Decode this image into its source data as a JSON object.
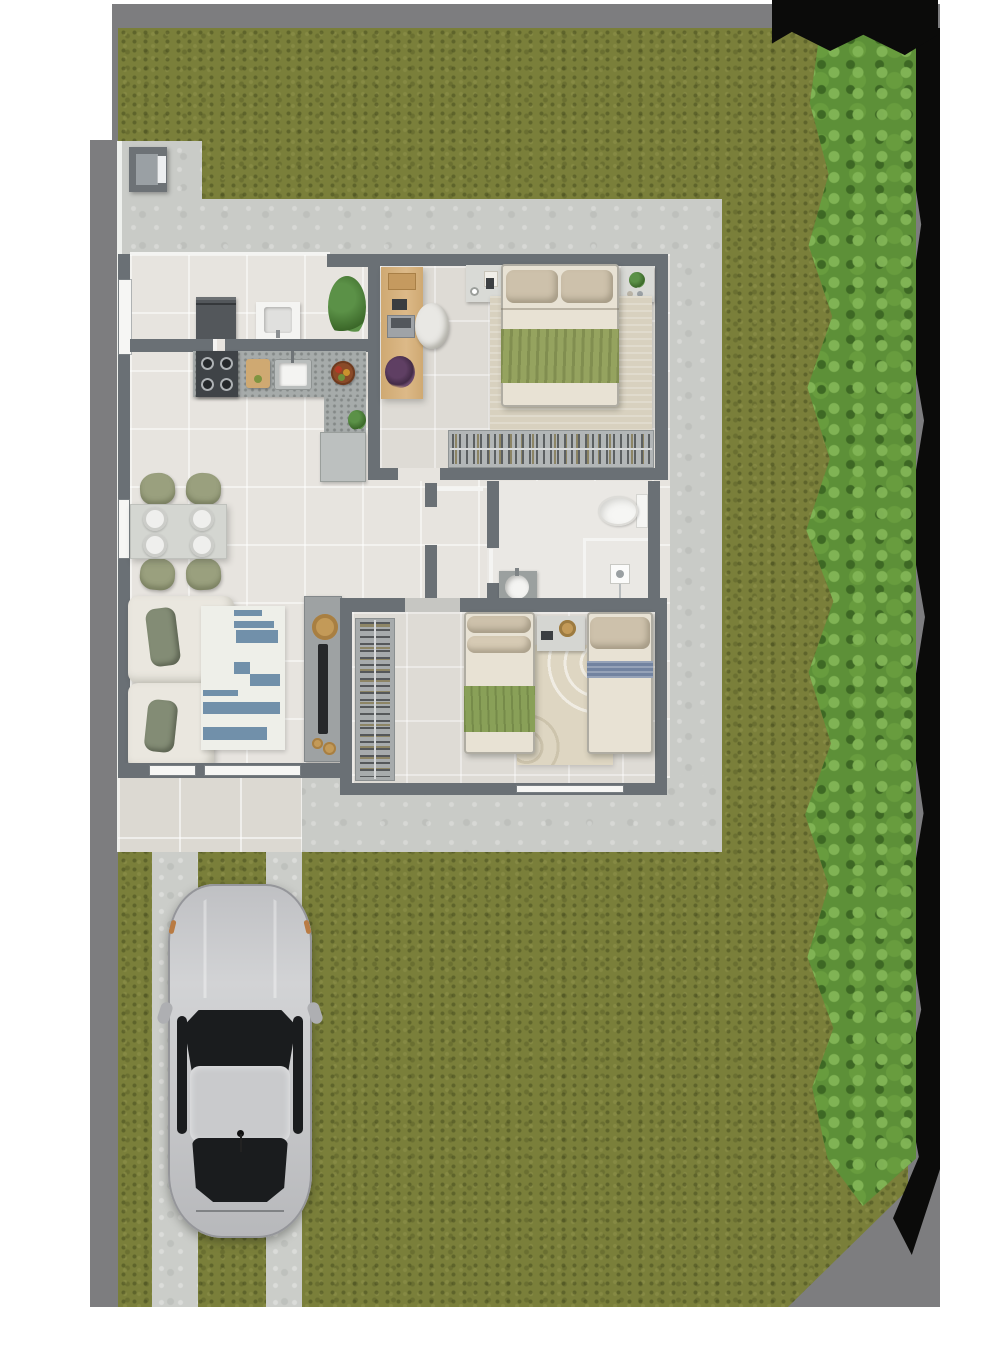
{
  "scene": {
    "type": "top-down architectural floor plan rendering",
    "areas": [
      "front-sidewalk",
      "entry-gate",
      "lawn",
      "hedge-with-shadow",
      "perimeter-walkway",
      "house",
      "rear-porch",
      "driveway",
      "parked-car"
    ]
  },
  "palette": {
    "page_bg": "#ffffff",
    "outside_gray": "#7d7d7f",
    "shadow_black": "#0b0b0a",
    "grass_base": "#7a7f3a",
    "hedge_base": "#5d9038",
    "walkway": "#c9cbc7",
    "porch_tile": "#dcd9d2",
    "curb_white": "#eef0ed",
    "wall": "#6a7075",
    "floor_living": "#e7e4df",
    "floor_bedroom": "#dedbd5",
    "floor_bath": "#eae8e4",
    "window_white": "#f6f6f4",
    "door_leaf": "#f4f4f2",
    "counter_gray": "#a6abaa",
    "stove_dark": "#3f4347",
    "fridge_gray": "#53575b",
    "cabinet_gray": "#bcc0bf",
    "sink_white": "#f4f4f2",
    "wood": "#cfa972",
    "bed_cream": "#e8e2d4",
    "pillow_tan": "#cdc1ab",
    "throw_green": "#95a35f",
    "rug_beige": "#d8d1bf",
    "rug_white": "#eeefe9",
    "stripe_blue": "#7190aa",
    "blanket_blue": "#7283a0",
    "blanket_green": "#89a058",
    "sofa_cream": "#eae7df",
    "sofa_pillow_olive": "#838c75",
    "chair_olive": "#9aa07e",
    "table_gray": "#d4d6d1",
    "plate_white": "#efefed",
    "tv_unit_gray": "#9ea2a3",
    "tv_black": "#26282a",
    "gold": "#c39a58",
    "plant_green": "#5b9147",
    "plant_dark": "#3a6628",
    "purple_plant": "#5f3f63",
    "car_silver": "#c8c9cb",
    "car_glass": "#1a1c1e",
    "driveway_strip": "#cbcdc9",
    "gate_box": "#6d7276",
    "gate_inner": "#9aa0a4"
  },
  "house": {
    "rooms": [
      {
        "name": "service-kitchen",
        "furniture": [
          "refrigerator",
          "laundry-tank",
          "potted-plant",
          "stove-4-burners",
          "cutting-board",
          "kitchen-sink",
          "fruit-bowl",
          "counter",
          "lower-cabinet"
        ]
      },
      {
        "name": "living-dining",
        "furniture": [
          "dining-table",
          "4-dining-chairs",
          "4-plates",
          "l-shaped-sofa",
          "2-sofa-pillows",
          "striped-rug",
          "tv-panel",
          "decor-tray",
          "decor-plates"
        ]
      },
      {
        "name": "master-bedroom",
        "furniture": [
          "desk",
          "office-chair",
          "double-bed",
          "2-pillows",
          "green-throw",
          "area-rug",
          "nightstand-left",
          "nightstand-right",
          "open-wardrobe"
        ]
      },
      {
        "name": "bathroom",
        "furniture": [
          "toilet",
          "shower-enclosure",
          "vanity-basin"
        ]
      },
      {
        "name": "second-bedroom",
        "furniture": [
          "clothes-rack",
          "single-bed-green",
          "single-bed-blue",
          "shared-nightstand",
          "arc-pattern-rug"
        ]
      }
    ]
  },
  "living_room": {
    "rug_stripes": [
      [
        33,
        4,
        28,
        6
      ],
      [
        33,
        15,
        40,
        7
      ],
      [
        35,
        24,
        42,
        13
      ],
      [
        33,
        56,
        16,
        12
      ],
      [
        49,
        68,
        30,
        12
      ],
      [
        2,
        84,
        35,
        6
      ],
      [
        2,
        96,
        77,
        12
      ],
      [
        2,
        121,
        64,
        13
      ]
    ]
  },
  "dining": {
    "plate_positions": [
      [
        13,
        3
      ],
      [
        60,
        3
      ],
      [
        13,
        29
      ],
      [
        60,
        29
      ]
    ],
    "plate_count": 4
  },
  "car": {
    "color": "silver",
    "orientation": "front-facing-up",
    "location": "driveway"
  }
}
